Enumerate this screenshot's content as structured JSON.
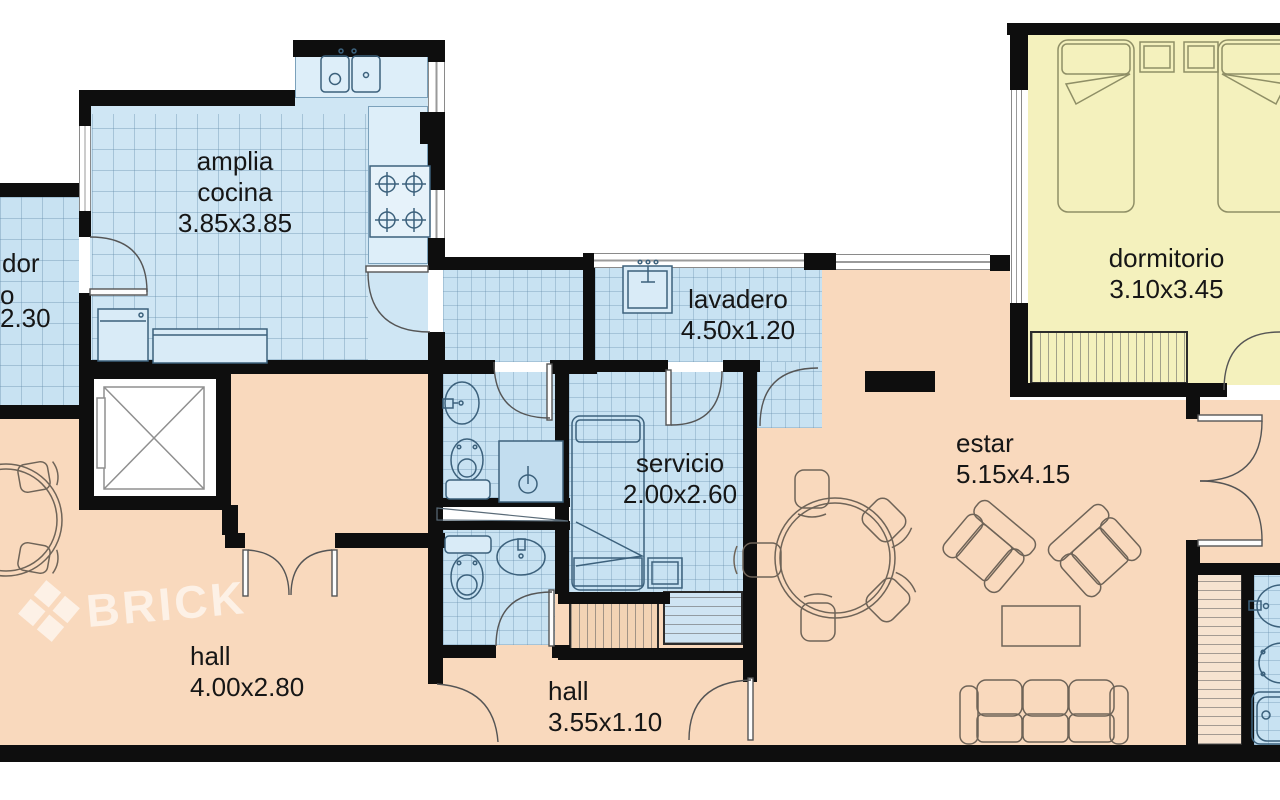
{
  "watermark": {
    "brand": "BRICK"
  },
  "labels": {
    "comedor": {
      "l1": "dor",
      "l2": "o",
      "l3": "2.30"
    },
    "cocina": {
      "l1": "amplia",
      "l2": "cocina",
      "l3": "3.85x3.85"
    },
    "lavadero": {
      "l1": "lavadero",
      "l2": "4.50x1.20"
    },
    "servicio": {
      "l1": "servicio",
      "l2": "2.00x2.60"
    },
    "dormitorio": {
      "l1": "dormitorio",
      "l2": "3.10x3.45"
    },
    "estar": {
      "l1": "estar",
      "l2": "5.15x4.15"
    },
    "hall_main": {
      "l1": "hall",
      "l2": "4.00x2.80"
    },
    "hall_small": {
      "l1": "hall",
      "l2": "3.55x1.10"
    }
  },
  "colors": {
    "wet_rooms": "#c8e2f2",
    "bedroom": "#f4f1bd",
    "living_areas": "#f9d9bd",
    "walls": "#0e0e0e",
    "watermark": "rgba(255,255,255,0.62)"
  }
}
